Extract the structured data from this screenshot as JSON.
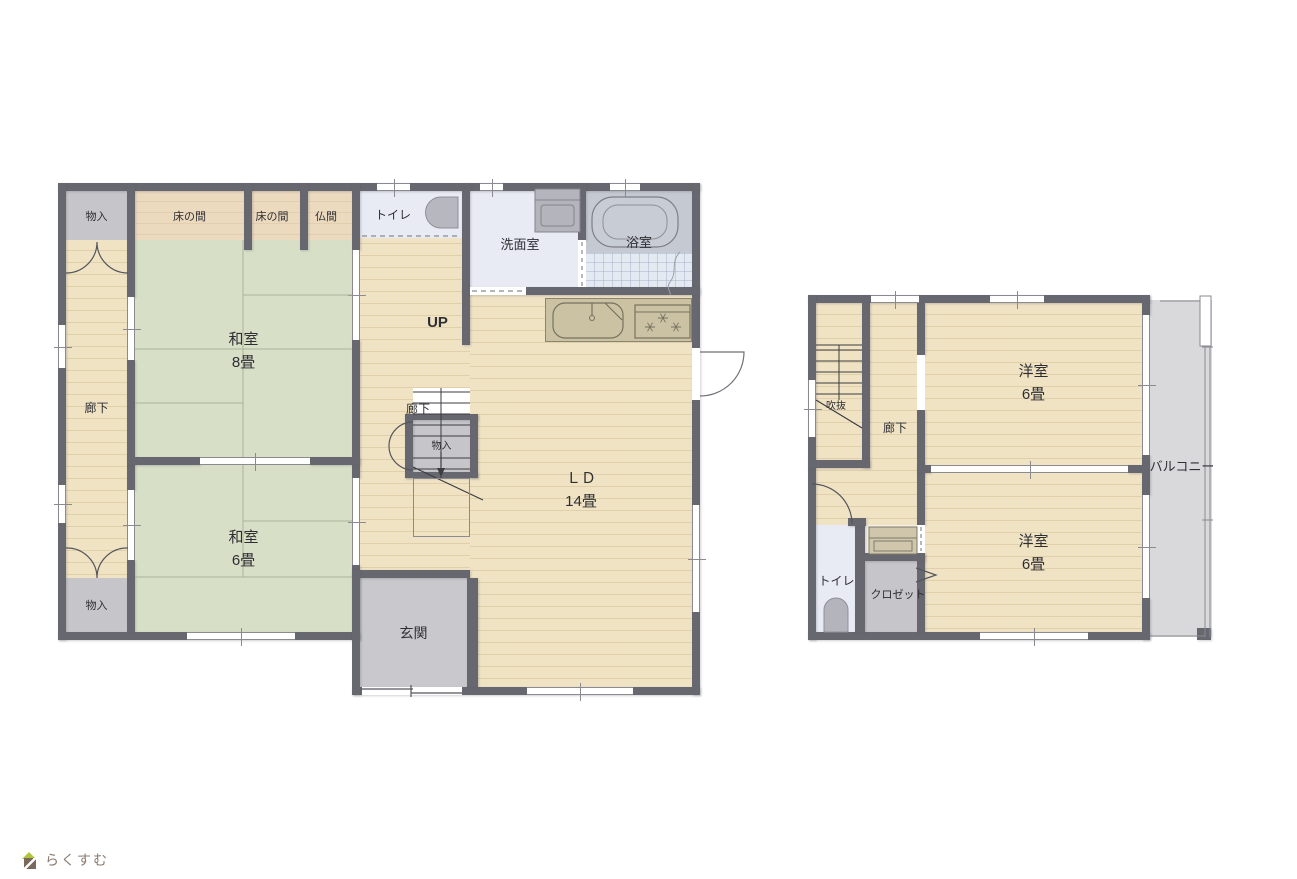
{
  "floor1": {
    "rooms": {
      "storage_top_left": "物入",
      "tokonoma_1": "床の間",
      "tokonoma_2": "床の間",
      "butsuma": "仏間",
      "toilet": "トイレ",
      "washroom": "洗面室",
      "bath": "浴室",
      "washitsu_8": {
        "name": "和室",
        "size": "8畳"
      },
      "washitsu_6": {
        "name": "和室",
        "size": "6畳"
      },
      "hallway_left": "廊下",
      "stairs_up": "UP",
      "hallway_center": "廊下",
      "storage_stairs": "物入",
      "living_dining": {
        "name": "ＬＤ",
        "size": "14畳"
      },
      "entrance": "玄関",
      "storage_bottom_left": "物入"
    }
  },
  "floor2": {
    "rooms": {
      "atrium": "吹抜",
      "hallway": "廊下",
      "western_room_top": {
        "name": "洋室",
        "size": "6畳"
      },
      "western_room_bottom": {
        "name": "洋室",
        "size": "6畳"
      },
      "balcony": "バルコニー",
      "toilet": "トイレ",
      "closet": "クロゼット"
    }
  },
  "logo": {
    "text": "らくすむ"
  },
  "colors": {
    "wall": "#67676f",
    "wood": "#f0e3c4",
    "tatami": "#d7dfc7",
    "tokonoma": "#ecdabf",
    "storage": "#c6c6ca",
    "entrance_floor": "#c9c9cd",
    "water_floor": "#e9ebf4",
    "bath_tile": "#e4eaf2",
    "bath_panel": "#c5c9d1",
    "kitchen": "#cbc2a4",
    "balcony_floor": "#d9d9dc",
    "fixture": "#b7b7bf",
    "line": "#8a8a90"
  }
}
